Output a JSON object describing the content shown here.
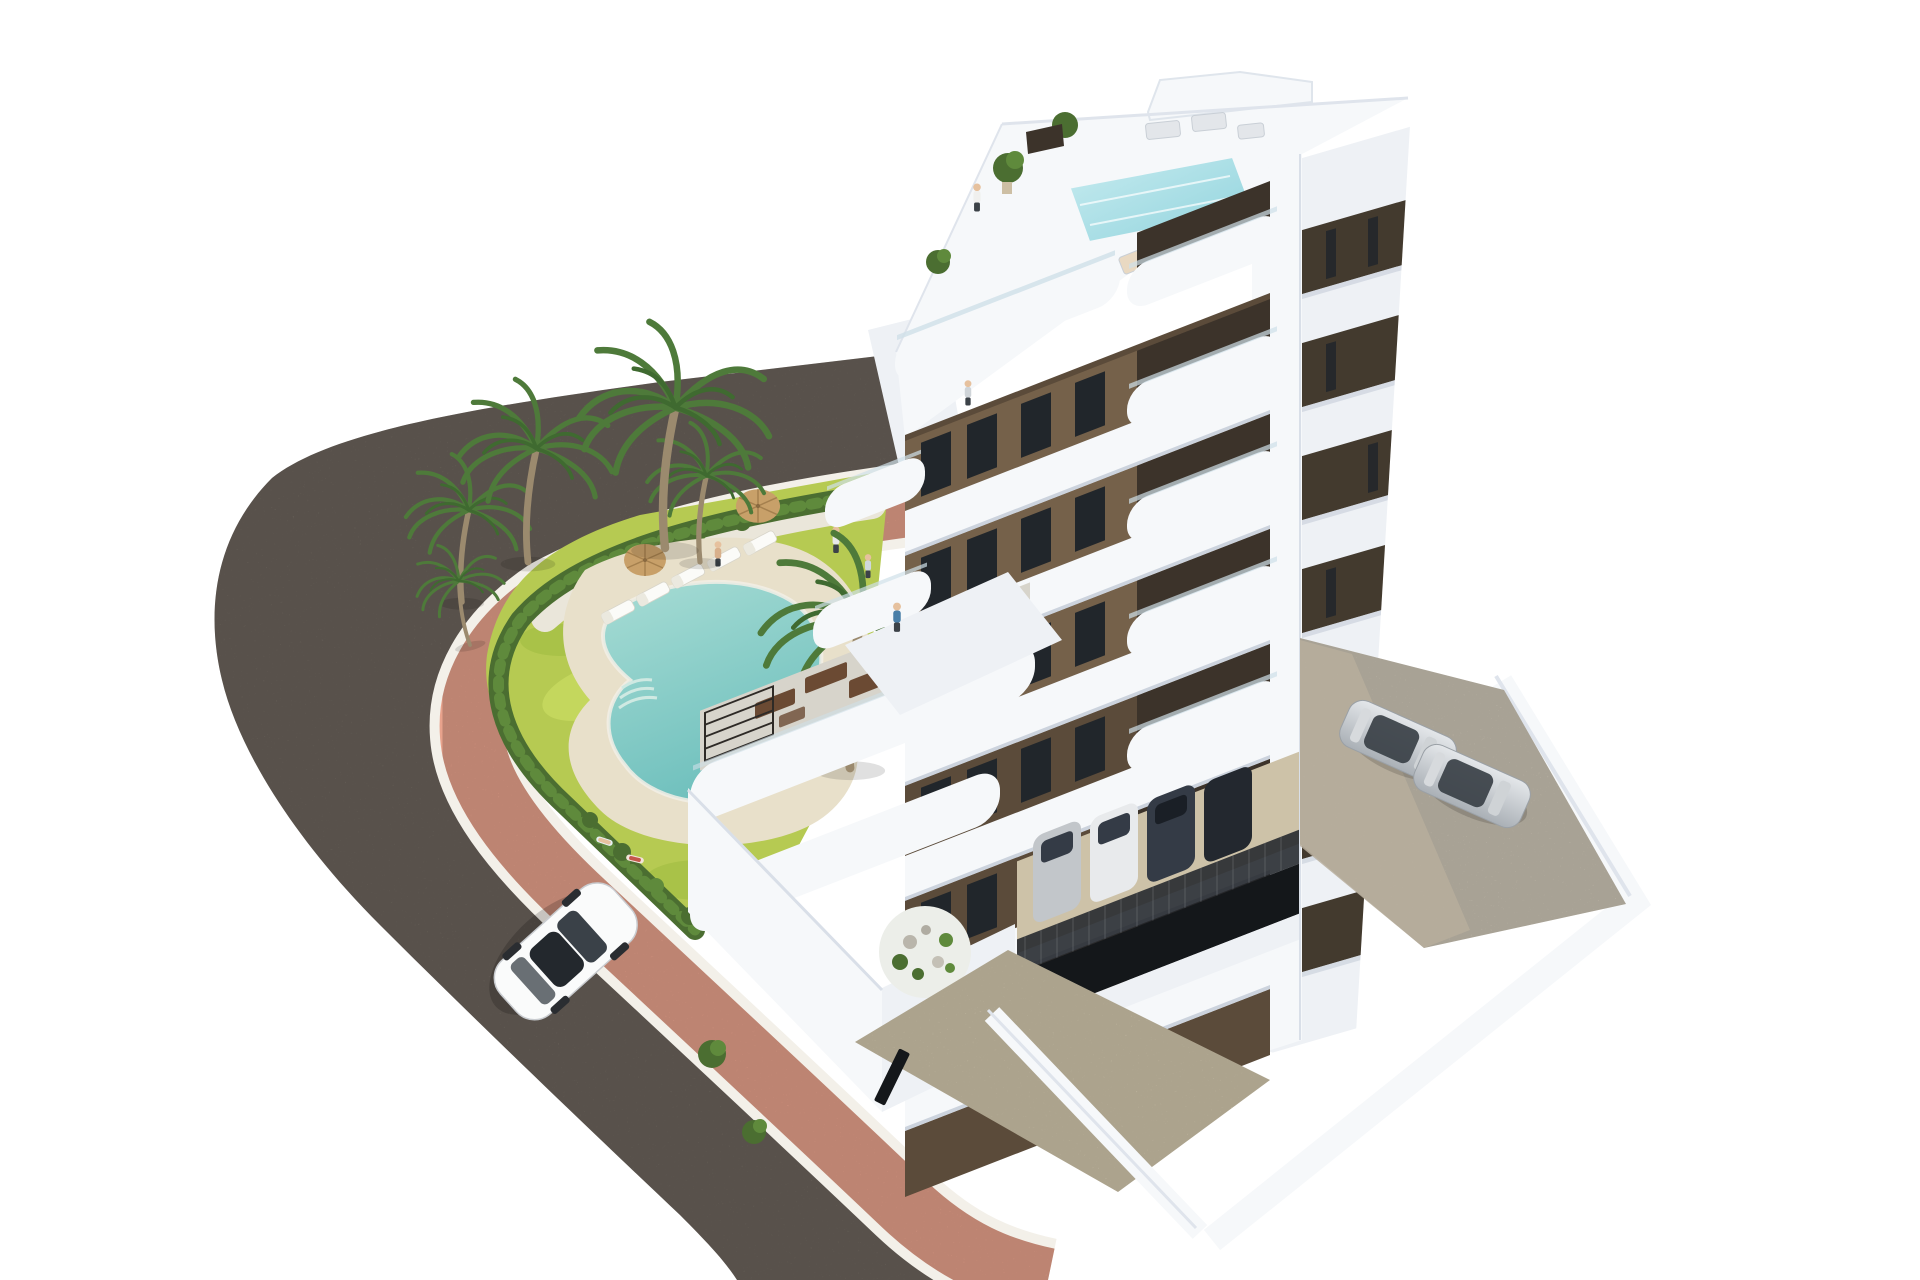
{
  "scene": {
    "type": "architectural-3d-render",
    "description": "Aerial 3D render of a modern seven-storey apartment building with white curved balconies and brown facade panels, rooftop terrace with plunge pool, landscaped garden with kidney-shaped swimming pool, sun loungers, parasols and palm trees, a curving asphalt road with pink pavement, a white car driving, and parking areas with cars",
    "background": "#ffffff"
  },
  "building": {
    "floor_count": 7,
    "style": "modern white building with curved balconies and brown facade panels",
    "features": [
      "rooftop terrace",
      "rooftop plunge pool",
      "glass balustrades",
      "curved white balcony fronts",
      "brown facade panels",
      "dark framed windows",
      "large ground-floor terraces",
      "pergola",
      "rock garden",
      "open parking garage"
    ]
  },
  "garden": {
    "features": [
      "kidney-shaped swimming pool",
      "beige pool deck",
      "sun loungers",
      "parasols",
      "palm trees",
      "hedge border",
      "lawn",
      "white gravel planting bed"
    ],
    "sun_lounger_count": 5,
    "parasol_count": 2,
    "palm_tree_count": 6
  },
  "road": {
    "surface": "dark asphalt",
    "sidewalk": "pink pavement with white curb lines",
    "shape": "curves around the garden from upper left to bottom edge"
  },
  "vehicles": {
    "street_car": {
      "color": "white",
      "count": 1
    },
    "parking_deck_cars": {
      "color": "silver",
      "count": 2
    },
    "garage_cars": {
      "count": 4
    }
  },
  "people": {
    "count": 9,
    "locations": [
      "rooftop terrace",
      "balconies",
      "terrace",
      "garden path",
      "poolside loungers"
    ]
  },
  "colors": {
    "bg": "#ffffff",
    "asphalt": "#7b7269",
    "sidewalk": "#e8a28c",
    "curb": "#f3f0e9",
    "hedge": "#4b6e31",
    "hedge_light": "#5f8a3c",
    "lawn": "#b6ca52",
    "lawn_light": "#cddf66",
    "lawn_dark": "#9cb93e",
    "gravel": "#eae6da",
    "deck_beige": "#e8e0ca",
    "pool": "#8fd0c9",
    "palm": "#4e7a3a",
    "palm_dark": "#3f6a30",
    "trunk": "#9b8a6e",
    "white_hi": "#f6f8fa",
    "white_mid": "#eef1f5",
    "white_shade": "#dfe4ec",
    "slab_shadow": "#ccd3dd",
    "brown": "#75614a",
    "brown_dark": "#5b4b3a",
    "recess": "#3c332a",
    "window": "#21262b",
    "band_dark": "#433a2e",
    "glass": "#cfe0e8",
    "roof_pool": "#aee2e9",
    "concrete": "#d9d1c0",
    "concrete_shadow": "#b7ae9c",
    "drive": "#d8cdb2",
    "garage_floor": "#cdc2a8",
    "garage_dark": "#14171a",
    "fence": "#22262b",
    "car_white": "#fafbfb",
    "car_silver": "#c2c6ca",
    "car_dark": "#343b46",
    "car_darker": "#23282f",
    "furniture": "#6b4a33",
    "umbrella": "#c8a069",
    "skin": "#e6c19e"
  }
}
